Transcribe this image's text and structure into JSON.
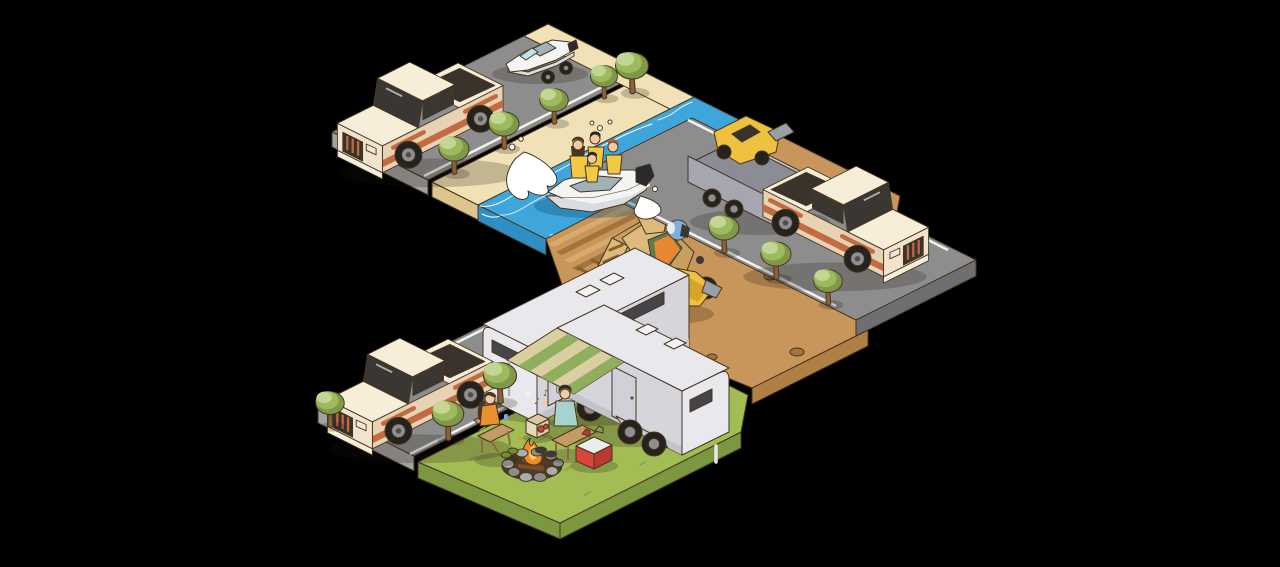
{
  "scene": {
    "description": "Isometric illustration on black background: pickup trucks towing a boat trailer, an ATV utility trailer and an RV camper along gray roads; a blue river with a speedboat carrying four people in yellow life vests; a dirt trail with a rock mesa and a quad-bike rider; and a campsite lawn with a second camper with striped awning, a campfire, two campers, a cooler and a radio",
    "objects": [
      {
        "id": "road-top",
        "label": "upper road"
      },
      {
        "id": "road-right",
        "label": "right road"
      },
      {
        "id": "road-bottom",
        "label": "campsite road"
      },
      {
        "id": "beach",
        "label": "sandy riverbank"
      },
      {
        "id": "river",
        "label": "river"
      },
      {
        "id": "dirt-trail",
        "label": "dirt ATV trail"
      },
      {
        "id": "rock-formation",
        "label": "rock mesa"
      },
      {
        "id": "campsite-lawn",
        "label": "campsite lawn"
      },
      {
        "id": "pickup-truck-boat",
        "label": "pickup truck towing boat trailer"
      },
      {
        "id": "boat-on-trailer",
        "label": "motorboat on trailer"
      },
      {
        "id": "speedboat",
        "label": "speedboat with four riders in life vests"
      },
      {
        "id": "utility-trailer-atv",
        "label": "utility trailer carrying quad bike"
      },
      {
        "id": "pickup-truck-right",
        "label": "pickup truck towing ATV trailer"
      },
      {
        "id": "quad-bike-rider",
        "label": "rider on yellow quad bike"
      },
      {
        "id": "pickup-truck-camper",
        "label": "pickup truck towing camper"
      },
      {
        "id": "camper-trailer-towed",
        "label": "towed RV camper"
      },
      {
        "id": "camper-trailer-awning",
        "label": "parked RV camper with awning"
      },
      {
        "id": "campfire",
        "label": "stone-ring campfire"
      },
      {
        "id": "camper-woman",
        "label": "seated woman with drink"
      },
      {
        "id": "camper-man",
        "label": "seated man roasting marshmallow"
      },
      {
        "id": "cooler",
        "label": "red cooler with drinks"
      },
      {
        "id": "radio",
        "label": "portable radio playing music"
      },
      {
        "id": "trees",
        "label": "roadside trees",
        "count": 11
      }
    ]
  },
  "props": {
    "music_note": "♪"
  },
  "palette": {
    "background": "#000000",
    "outline": "#46351f",
    "line": "#f2f2f0",
    "road": "#8d8d8d",
    "road_side": "#a2a2a2",
    "road_dark": "#6f6f72",
    "sand": "#f0e2b6",
    "sand_side": "#dcc68e",
    "water": "#3fa6dc",
    "water_side": "#2e8fc5",
    "foam": "#ffffff",
    "dirt": "#c8955a",
    "dirt_light": "#d8ab6c",
    "dirt_dark": "#a5743c",
    "dirt_track": "#8a5f2c",
    "dirt_side": "#b07f46",
    "rock_light": "#ddba7c",
    "rock_mid": "#c99f5f",
    "rock_dark": "#a8813f",
    "grass": "#a3bd55",
    "grass_side": "#7b9740",
    "grass_dark": "#85a042",
    "tree_light": "#c3d694",
    "tree_mid": "#9dba5e",
    "tree_dark": "#7e9a48",
    "trunk": "#8a6239",
    "shadow": "rgba(30,22,12,0.22)",
    "truck_body": "#f2e4cc",
    "truck_top": "#f7eeda",
    "truck_shade": "#e7d2b4",
    "truck_accent": "#c26a40",
    "glass": "#3a3733",
    "tire": "#26221e",
    "rim": "#8f8f8f",
    "hub": "#4d4d4d",
    "bed": "#3a332b",
    "headlight": "#efe8d8",
    "trailer_gray": "#a6a6b0",
    "trailer_dark": "#8c8c96",
    "trailer_light": "#c8c8d0",
    "atv_yellow": "#eec23e",
    "atv_shade": "#d8a32b",
    "rack_gray": "#9aa0a8",
    "helmet_blue": "#82aedc",
    "vest_orange": "#e8872f",
    "rider_green": "#5f7c4e",
    "rider_green_dark": "#4c6a40",
    "vest_yellow": "#f2c844",
    "skin": "#f3cba5",
    "hair_dark": "#2c241e",
    "hair_brown": "#4d3524",
    "hair_red": "#b5553a",
    "boat_white": "#f4f4f2",
    "boat_gray": "#d9dde0",
    "boat_deck": "#9fb2b8",
    "boat_glass": "#bfe3ee",
    "motor_dark": "#2a2a2e",
    "camper_body": "#e9e9ed",
    "camper_side": "#d5d5db",
    "camper_band": "#c3c3cb",
    "camper_slot": "#44444a",
    "camper_door": "#d0d0d6",
    "fender_light": "#c8c8ce",
    "awning_tan": "#d9cfa0",
    "awning_green": "#8fae5e",
    "pole_gray": "#b0b0b8",
    "wood": "#c29b66",
    "wood_dark": "#8a6a45",
    "shirt_orange": "#e9912e",
    "shirt_teal": "#a5d3ce",
    "jeans": "#5a6c8c",
    "shoe_dark": "#3a3a3a",
    "shoe_green": "#6f8f3f",
    "fire_orange": "#f28b27",
    "fire_yellow": "#fbce4d",
    "stone_light": "#ababab",
    "stone_dark": "#8d8d8d",
    "pit_brown": "#4e3b27",
    "log_brown": "#7a4e28",
    "cooler_red": "#d9453c",
    "cooler_dark": "#b93a32",
    "cooler_lid": "#ececec",
    "cup_red": "#c03a35",
    "cup_green": "#7fa05a",
    "radio_tan": "#d9c9a0",
    "radio_face": "#e6d9b8",
    "radio_red": "#c14b44",
    "marshmallow": "#f5f0e6",
    "jack_white": "#e8e8e8",
    "water_shadow": "rgba(20,80,120,0.35)"
  }
}
